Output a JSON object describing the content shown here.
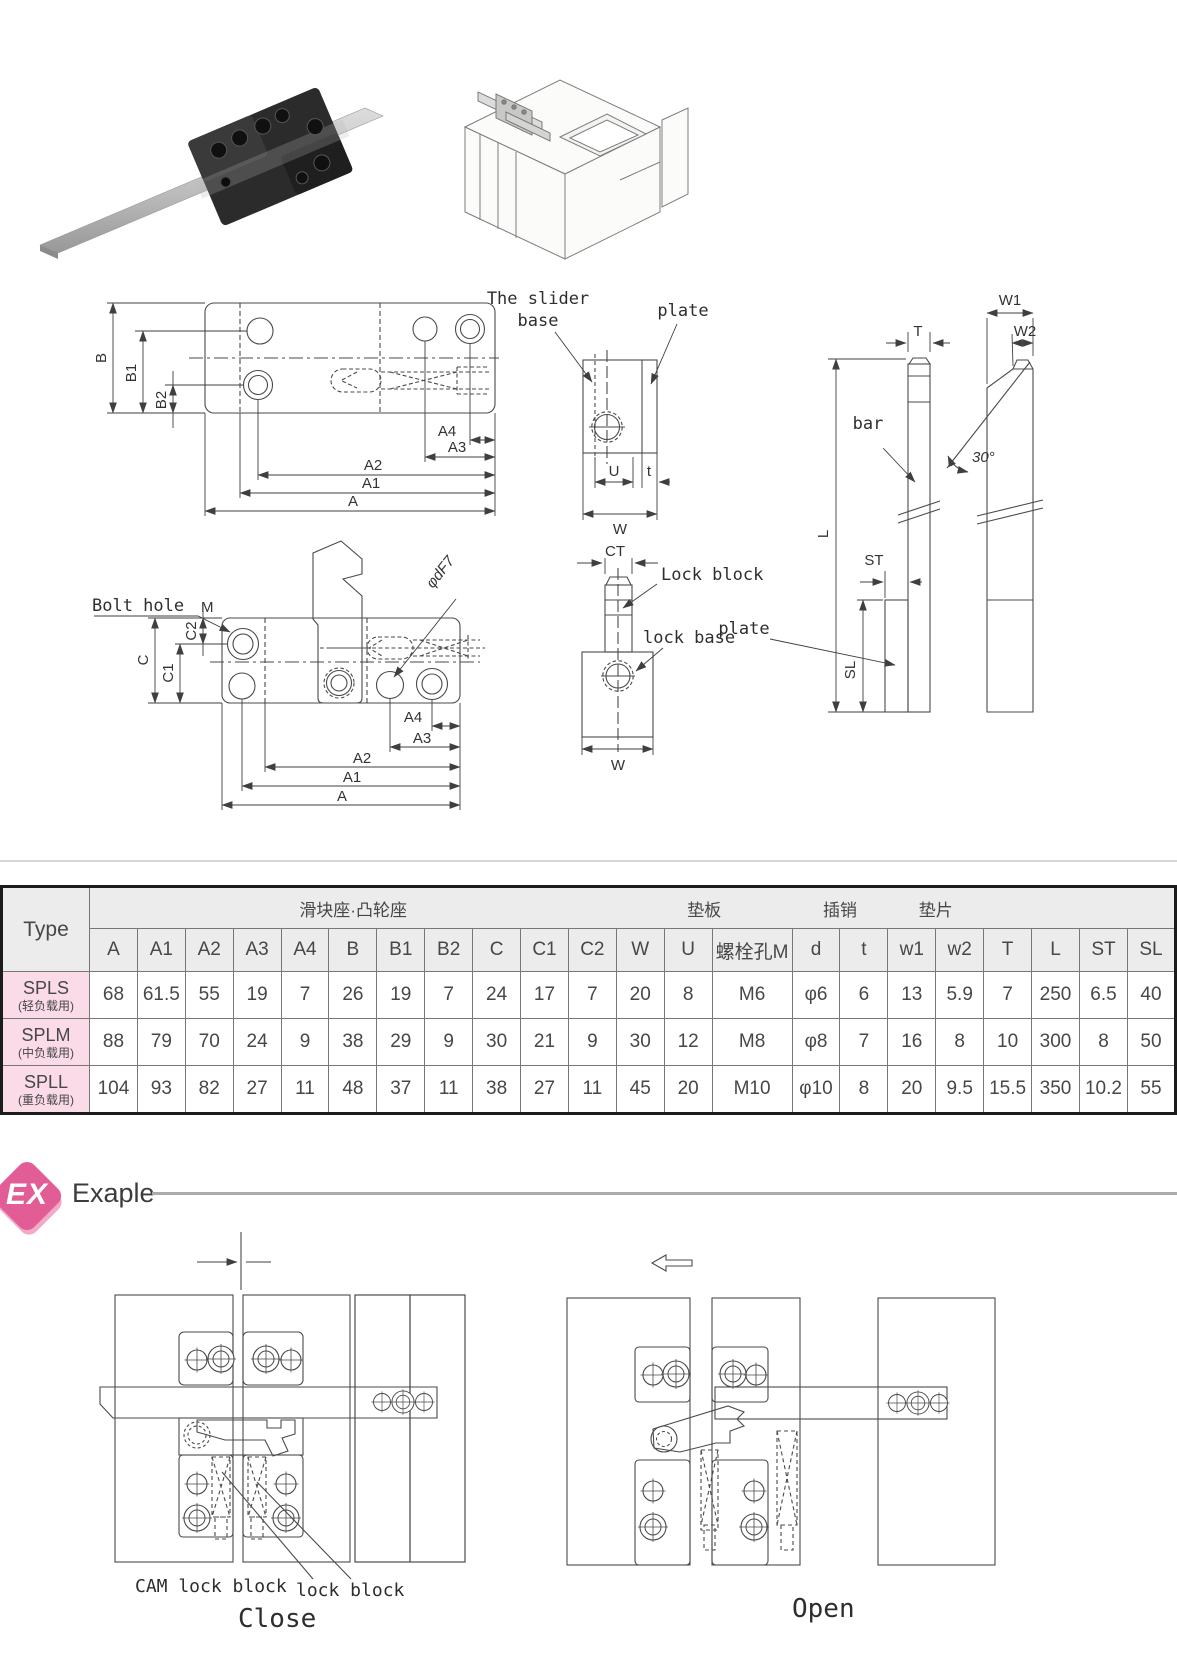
{
  "table": {
    "type_header": "Type",
    "groups": [
      {
        "label": "滑块座·凸轮座",
        "span": 11
      },
      {
        "label": "垫板",
        "span": 3
      },
      {
        "label": "插销",
        "span": 2
      },
      {
        "label": "垫片",
        "span": 2
      },
      {
        "label": "",
        "span": 4
      }
    ],
    "columns": [
      "A",
      "A1",
      "A2",
      "A3",
      "A4",
      "B",
      "B1",
      "B2",
      "C",
      "C1",
      "C2",
      "W",
      "U",
      "螺栓孔M",
      "d",
      "t",
      "w1",
      "w2",
      "T",
      "L",
      "ST",
      "SL"
    ],
    "rows": [
      {
        "type": "SPLS",
        "type_sub": "(轻负载用)",
        "values": [
          "68",
          "61.5",
          "55",
          "19",
          "7",
          "26",
          "19",
          "7",
          "24",
          "17",
          "7",
          "20",
          "8",
          "M6",
          "φ6",
          "6",
          "13",
          "5.9",
          "7",
          "250",
          "6.5",
          "40"
        ]
      },
      {
        "type": "SPLM",
        "type_sub": "(中负载用)",
        "values": [
          "88",
          "79",
          "70",
          "24",
          "9",
          "38",
          "29",
          "9",
          "30",
          "21",
          "9",
          "30",
          "12",
          "M8",
          "φ8",
          "7",
          "16",
          "8",
          "10",
          "300",
          "8",
          "50"
        ]
      },
      {
        "type": "SPLL",
        "type_sub": "(重负载用)",
        "values": [
          "104",
          "93",
          "82",
          "27",
          "11",
          "48",
          "37",
          "11",
          "38",
          "27",
          "11",
          "45",
          "20",
          "M10",
          "φ10",
          "8",
          "20",
          "9.5",
          "15.5",
          "350",
          "10.2",
          "55"
        ]
      }
    ]
  },
  "drawings": {
    "plan": {
      "B": "B",
      "B1": "B1",
      "B2": "B2",
      "A": "A",
      "A1": "A1",
      "A2": "A2",
      "A3": "A3",
      "A4": "A4"
    },
    "side": {
      "label_line1": "The slider",
      "label_line2": "base",
      "plate": "plate",
      "U": "U",
      "t": "t",
      "W": "W"
    },
    "cam": {
      "bolt_hole": "Bolt hole",
      "m": "M",
      "C": "C",
      "C1": "C1",
      "C2": "C2",
      "A": "A",
      "A1": "A1",
      "A2": "A2",
      "A3": "A3",
      "A4": "A4",
      "phi": "φdF7"
    },
    "lock": {
      "CT": "CT",
      "lock_block": "Lock block",
      "lock_base": "lock base",
      "W": "W"
    },
    "bars": {
      "T": "T",
      "L": "L",
      "ST": "ST",
      "SL": "SL",
      "W1": "W1",
      "W2": "W2",
      "bar": "bar",
      "plate": "plate",
      "angle": "30°"
    }
  },
  "example": {
    "badge": "EX",
    "heading": "Exaple",
    "cam_label": "CAM lock block",
    "lock_label": "lock block",
    "close_label": "Close",
    "open_label": "Open"
  },
  "colors": {
    "badge_pink": "#e25d96",
    "row_pink": "#fadbe7",
    "header_gray": "#ececec",
    "drawing_fill": "#eceded",
    "cam_gray": "#a3a3a1"
  }
}
